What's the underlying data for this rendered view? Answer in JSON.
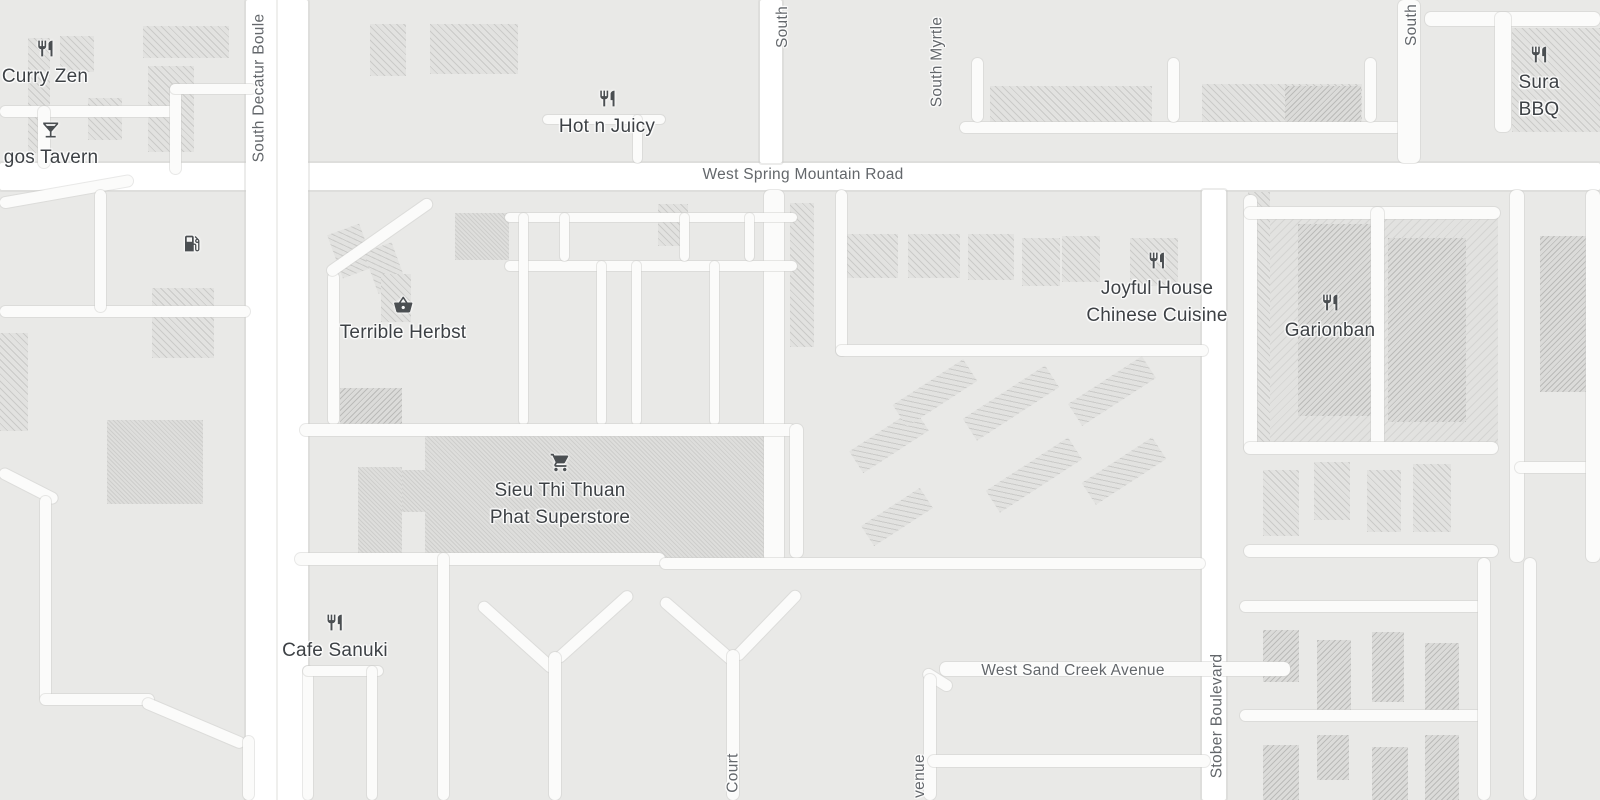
{
  "streets": {
    "west_spring_mountain_road": "West Spring Mountain Road",
    "south_decatur_boulevard_partial": "South Decatur Boule",
    "south_partial_left": "South",
    "south_myrtle": "South Myrtle",
    "south_partial_right": "South",
    "west_sand_creek_avenue": "West Sand Creek Avenue",
    "stober_boulevard": "Stober Boulevard",
    "court_partial": "Court",
    "avenue_partial": "venue"
  },
  "pois": {
    "curry_zen": {
      "name": "Curry Zen",
      "icon": "restaurant"
    },
    "tavern_partial": {
      "name": "gos Tavern",
      "icon": "cocktail"
    },
    "gas_station": {
      "icon": "gas-pump"
    },
    "hot_n_juicy": {
      "name": "Hot n Juicy",
      "icon": "restaurant"
    },
    "terrible_herbst": {
      "name": "Terrible Herbst",
      "icon": "shopping-basket"
    },
    "sieu_thi_thuan_phat": {
      "name": "Sieu Thi Thuan\nPhat Superstore",
      "icon": "shopping-cart"
    },
    "joyful_house": {
      "name": "Joyful House\nChinese Cuisine",
      "icon": "restaurant"
    },
    "garionban": {
      "name": "Garionban",
      "icon": "restaurant"
    },
    "sura_bbq": {
      "name": "Sura BBQ",
      "icon": "restaurant"
    },
    "cafe_sanuki": {
      "name": "Cafe Sanuki",
      "icon": "restaurant"
    }
  },
  "colors": {
    "background": "#e9e9e7",
    "road": "#fbfbfa",
    "road_major": "#ffffff",
    "road_casing": "#d5d5d2",
    "building": "#e2e2e0",
    "building_hatch": "#c6c6c4",
    "poi_text": "#3d4145",
    "street_text": "#63676b",
    "icon_color": "#4b4f52"
  }
}
